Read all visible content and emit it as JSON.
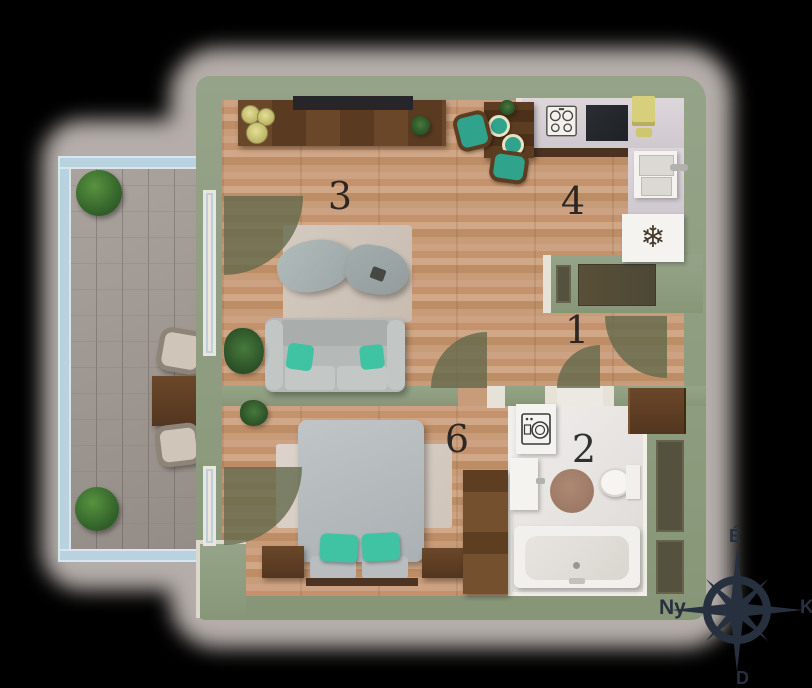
{
  "title": "Apartment floor plan",
  "rooms": {
    "hallway": {
      "number": "1"
    },
    "bathroom": {
      "number": "2"
    },
    "living_room": {
      "number": "3"
    },
    "kitchen": {
      "number": "4"
    },
    "bedroom": {
      "number": "6"
    }
  },
  "compass": {
    "north_label": "É",
    "west_label": "Ny",
    "east_label": "K",
    "south_label": "D"
  },
  "icons": {
    "fridge_snowflake": "❄",
    "stove_icon": "stove-burners",
    "washing_machine_icon": "washer-drum",
    "compass_icon": "compass-rose"
  },
  "colors": {
    "wall": "#8c9a80",
    "wood_floor": "#c79a76",
    "terrace_tile": "#a29b95",
    "railing": "#b9d2e0",
    "accent_teal": "#3fc3a3",
    "furniture_brown": "#5d3d24",
    "bathroom_floor": "#e9e7e4",
    "compass": "#26303f",
    "shadow_halo": "#b4ada9",
    "background": "#000000"
  }
}
